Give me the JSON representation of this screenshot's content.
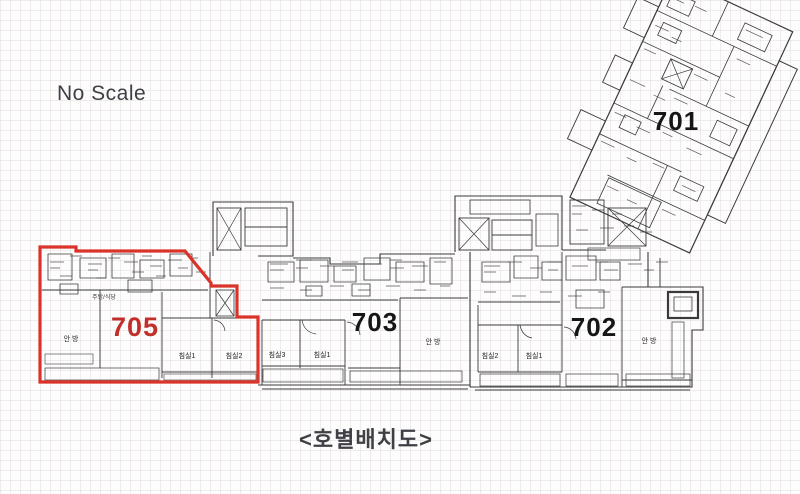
{
  "page": {
    "scale_note": "No Scale",
    "caption": "<호별배치도>"
  },
  "units": {
    "u701": {
      "number": "701"
    },
    "u702": {
      "number": "702",
      "rooms": {
        "master": "안 방",
        "bed1": "침실1",
        "bed2": "침실2"
      }
    },
    "u703": {
      "number": "703",
      "rooms": {
        "master": "안 방",
        "bed1": "침실1",
        "bed3": "침실3"
      }
    },
    "u705": {
      "number": "705",
      "rooms": {
        "master": "안 방",
        "bed1": "침실1",
        "bed2": "침실2",
        "kitchen": "주방/식당"
      }
    }
  },
  "colors": {
    "highlight_outline": "#da332a",
    "highlight_number": "#c22f2b",
    "plan_line": "#3a3a3a",
    "text": "#3f3f46"
  }
}
